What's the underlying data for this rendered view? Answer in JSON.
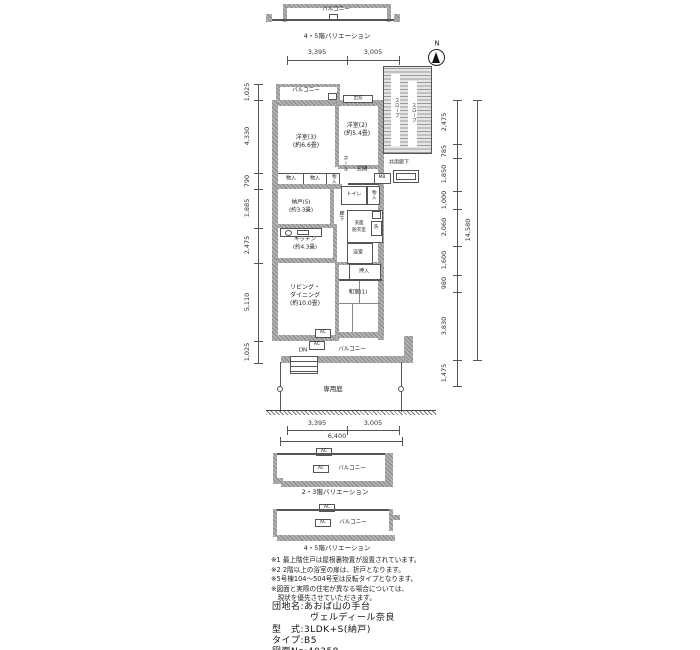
{
  "compass": {
    "north": "N"
  },
  "top_variation": {
    "balcony": "バルコニー",
    "caption": "4・5階バリエーション"
  },
  "top_dims": {
    "d1": "3,395",
    "d2": "3,005"
  },
  "plan": {
    "balcony_top": "バルコニー",
    "bay_window": "出窓",
    "room3": "洋室(3)",
    "room3_size": "(約6.6畳)",
    "room2": "洋室(2)",
    "room2_size": "(約5.4畳)",
    "slope1": "スロープ",
    "slope2": "スロープ",
    "common_corridor": "共用廊下",
    "storage1": "物入",
    "storage2": "物入",
    "storage3": "物入",
    "storage4": "物入",
    "hall": "ホール",
    "entrance": "玄関",
    "mb": "MB",
    "toilet": "トイレ",
    "nando": "納戸(S)",
    "nando_size": "(約3.3畳)",
    "corridor": "廊下",
    "washroom_l1": "洗面",
    "washroom_l2": "脱衣室",
    "laundry": "洗",
    "kitchen": "キッチン",
    "kitchen_size": "(約4.3畳)",
    "bath": "浴室",
    "oshiire": "押入",
    "japanese_room": "和室(1)",
    "living_l1": "リビング・",
    "living_l2": "ダイニング",
    "living_size": "(約10.0畳)",
    "ac1": "AC",
    "ac2": "AC",
    "dn": "DN",
    "balcony_bottom": "バルコニー",
    "private_garden": "専用庭",
    "dims_left": [
      "1,025",
      "4,330",
      "790",
      "1,885",
      "2,475",
      "5,110",
      "1,025"
    ],
    "dims_right": [
      "2,475",
      "785",
      "1,850",
      "1,000",
      "2,060",
      "1,600",
      "980",
      "3,830"
    ],
    "dims_right_total": "14,580",
    "dim_below_right": "1,475"
  },
  "bottom_dims": {
    "d1": "3,395",
    "d2": "3,005",
    "total": "6,400"
  },
  "mid_variation": {
    "ac1": "AC",
    "ac2": "AC",
    "balcony": "バルコニー",
    "caption": "2・3階バリエーション"
  },
  "bottom_variation": {
    "ac1": "AC",
    "ac2": "AC",
    "balcony": "バルコニー",
    "caption": "4・5階バリエーション"
  },
  "notes": [
    "※1 最上階住戸は屋根裏物置が設置されています。",
    "※2 2階以上の浴室の扉は、折戸となります。",
    "※5号棟104〜504号室は反転タイプとなります。",
    "※図面と実際の住宅が異なる場合については、",
    "　現状を優先させていただきます。"
  ],
  "property": {
    "estate_label": "団地名:",
    "estate_name_1": "あおば山の手台",
    "estate_name_2": "ヴェルディール奈良",
    "type_label": "型　式:",
    "type_value": "3LDK+S(納戸)",
    "plan_label": "タイプ:",
    "plan_value": "B5",
    "no_label": "図面No:",
    "no_value": "40358"
  },
  "colors": {
    "wall": "#9e9e9e",
    "line": "#555555",
    "text": "#1c1c1c"
  }
}
